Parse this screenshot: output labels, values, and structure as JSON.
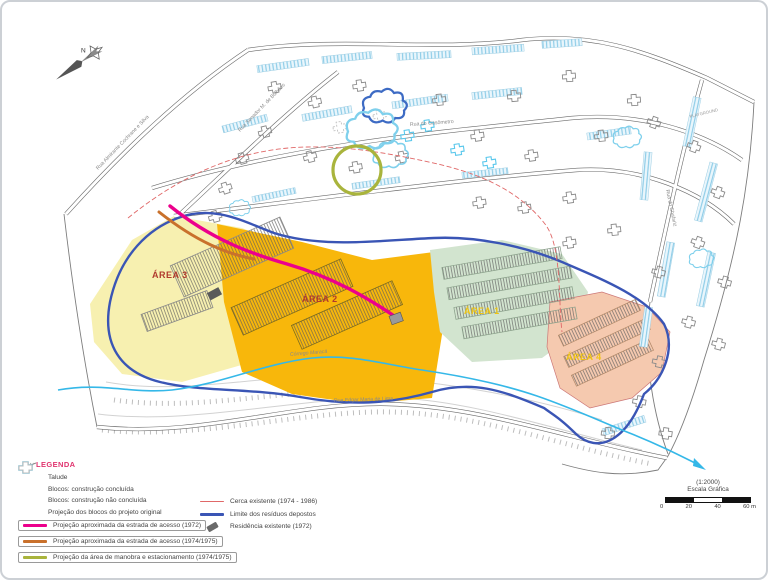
{
  "map": {
    "north_label": "N",
    "labels": {
      "area1": "ÁREA 1",
      "area2": "ÁREA 2",
      "area3": "ÁREA 3",
      "area4": "ÁREA 4",
      "stream": "Córrego Maracá",
      "street_a": "Rua Almirante Cochrane e Silva",
      "street_b": "Rua Senador M. de Bulhões",
      "street_c": "Rua do Gasômetro",
      "street_d": "Rua do Chafariz",
      "street_e": "Rua Edgar Maria de Lima",
      "playground": "PLAYGROUND"
    }
  },
  "legend": {
    "title": "LEGENDA",
    "items_left": [
      "Talude",
      "Blocos: construção concluída",
      "Blocos: construção não concluída",
      "Projeção dos blocos do projeto original",
      "Projeção aproximada da estrada de acesso (1972)",
      "Projeção aproximada da estrada de acesso (1974/1975)",
      "Projeção da área de manobra e estacionamento  (1974/1975)"
    ],
    "items_right": [
      "Cerca existente (1974 - 1986)",
      "Limite dos resíduos depostos",
      "Residência existente (1972)"
    ]
  },
  "scale": {
    "ratio": "(1:2000)",
    "caption": "Escala Gráfica",
    "ticks": [
      "0",
      "20",
      "40",
      "60 m"
    ]
  },
  "colors": {
    "area1": "#D2E4CF",
    "area2": "#F8B70B",
    "area3": "#F7F0B0",
    "area4": "#F5C9AF",
    "access_1972": "#EC008C",
    "access_1974": "#C9712C",
    "manobra_estacionamento": "#A9B43C",
    "limite_residuos": "#3A55B5",
    "cerca_existente": "#E06868",
    "corrego": "#35B8E8",
    "blocos_nao_concluida": "#5BC8EC",
    "legenda_title": "#E0336E"
  }
}
